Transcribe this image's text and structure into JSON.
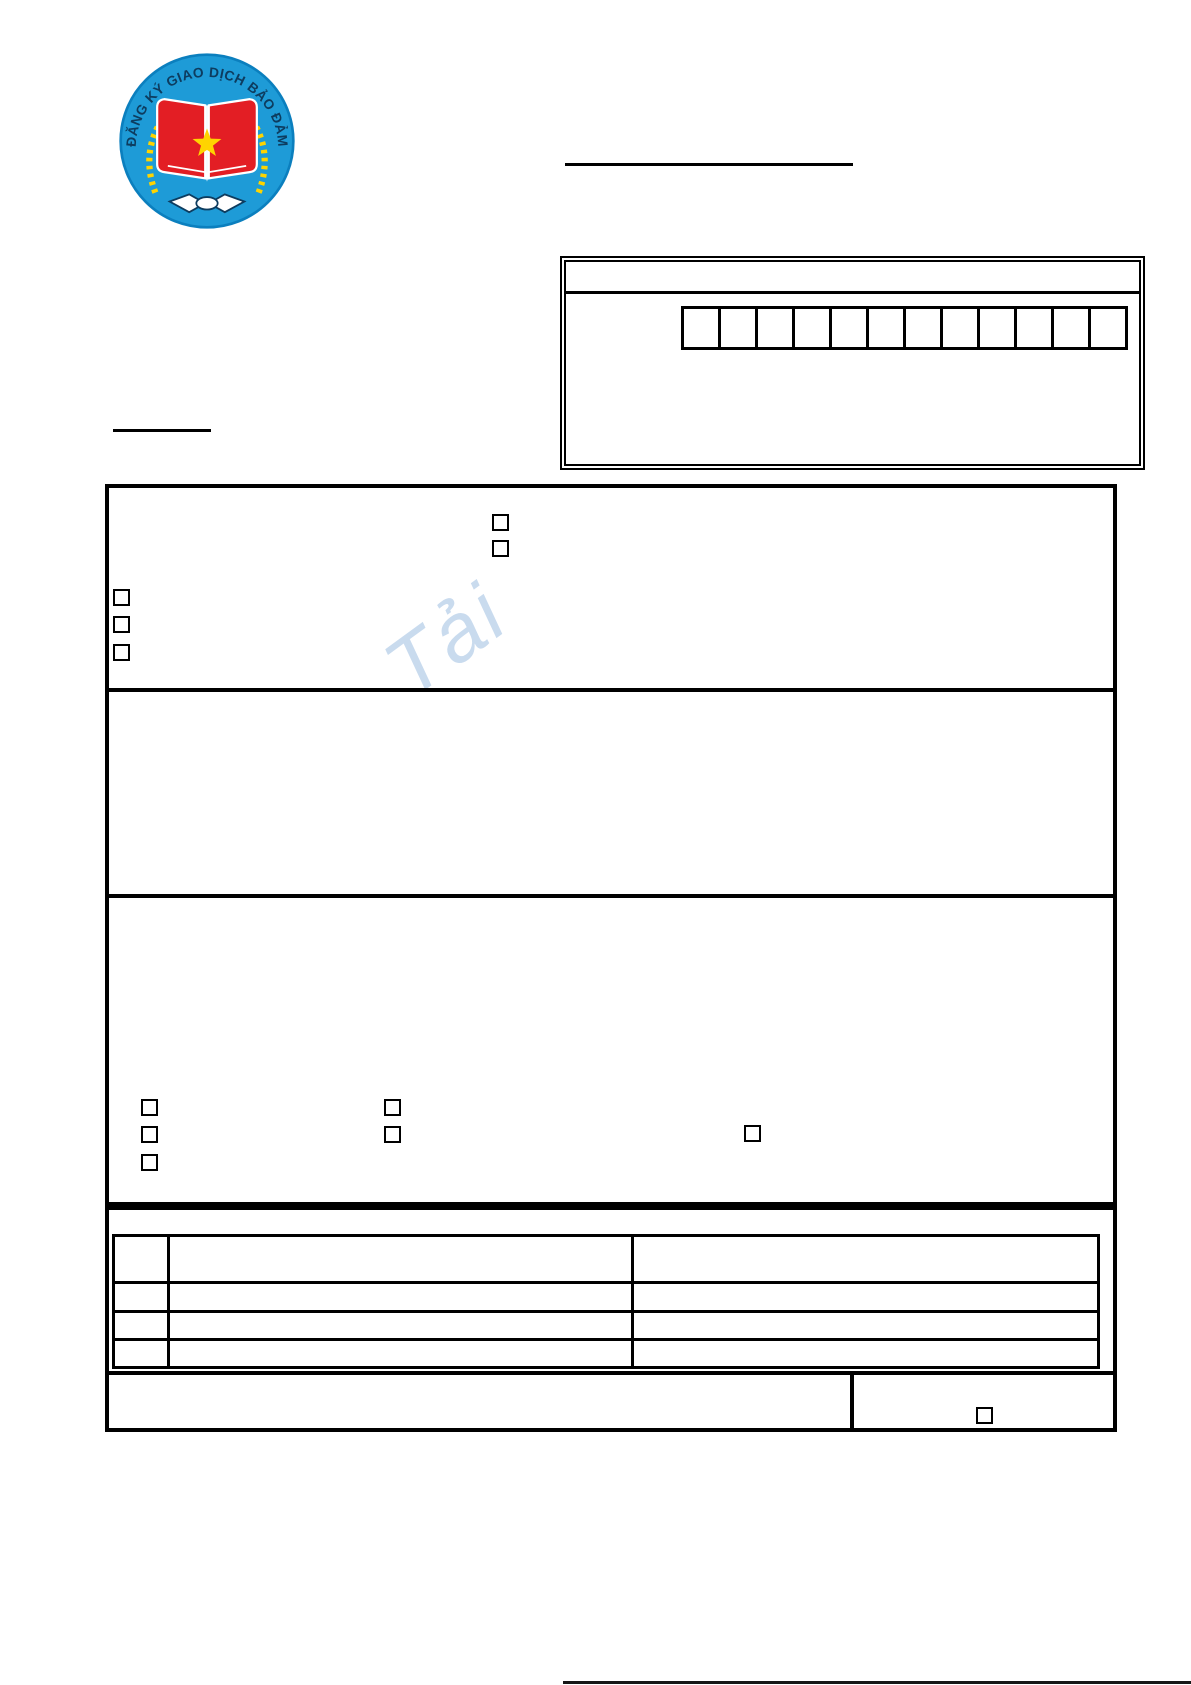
{
  "logo": {
    "ring_text": "ĐĂNG KÝ GIAO DỊCH BẢO ĐẢM",
    "colors": {
      "circle_blue": "#1e9bd7",
      "rim_blue": "#0b7fbe",
      "book_red": "#e31e24",
      "star_yellow": "#ffd400",
      "branch_yellow": "#ffd400",
      "ring_text_color": "#0d3c5f"
    }
  },
  "watermark": {
    "text": "Tải",
    "color": "#b7cfe9"
  },
  "code_box": {
    "cell_count": 12,
    "cells": [
      "",
      "",
      "",
      "",
      "",
      "",
      "",
      "",
      "",
      "",
      "",
      ""
    ]
  },
  "sections": {
    "section1": {
      "center_checkboxes": [
        false,
        false
      ],
      "left_checkboxes": [
        false,
        false,
        false
      ]
    },
    "section2": {},
    "section3": {
      "column1_checkboxes": [
        false,
        false,
        false
      ],
      "column2_checkboxes": [
        false,
        false
      ],
      "column3_checkboxes": [
        false
      ]
    }
  },
  "table": {
    "rows": [
      [
        "",
        "",
        ""
      ],
      [
        "",
        "",
        ""
      ],
      [
        "",
        "",
        ""
      ],
      [
        "",
        "",
        ""
      ]
    ]
  },
  "footer_box": {
    "checkbox": false
  }
}
